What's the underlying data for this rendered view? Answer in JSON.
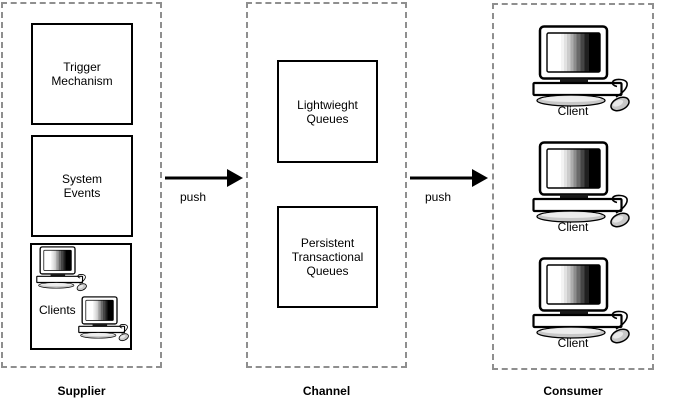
{
  "supplier": {
    "label": "Supplier",
    "trigger_box_label": "Trigger\nMechanism",
    "system_box_label": "System\nEvents",
    "clients_label": "Clients"
  },
  "channel": {
    "label": "Channel",
    "lightweight_box_label": "Lightwieght\nQueues",
    "persistent_box_label": "Persistent\nTransactional\nQueues"
  },
  "consumer": {
    "label": "Consumer",
    "client_labels": [
      "Client",
      "Client",
      "Client"
    ]
  },
  "arrows": {
    "first_label": "push",
    "second_label": "push"
  },
  "icons": {
    "computer": "desktop-computer-icon"
  },
  "colors": {
    "background": "#ffffff",
    "dashed_border": "#8f8f8f",
    "solid_border": "#000000",
    "text": "#000000",
    "device_gray": "#c8c8c8"
  }
}
